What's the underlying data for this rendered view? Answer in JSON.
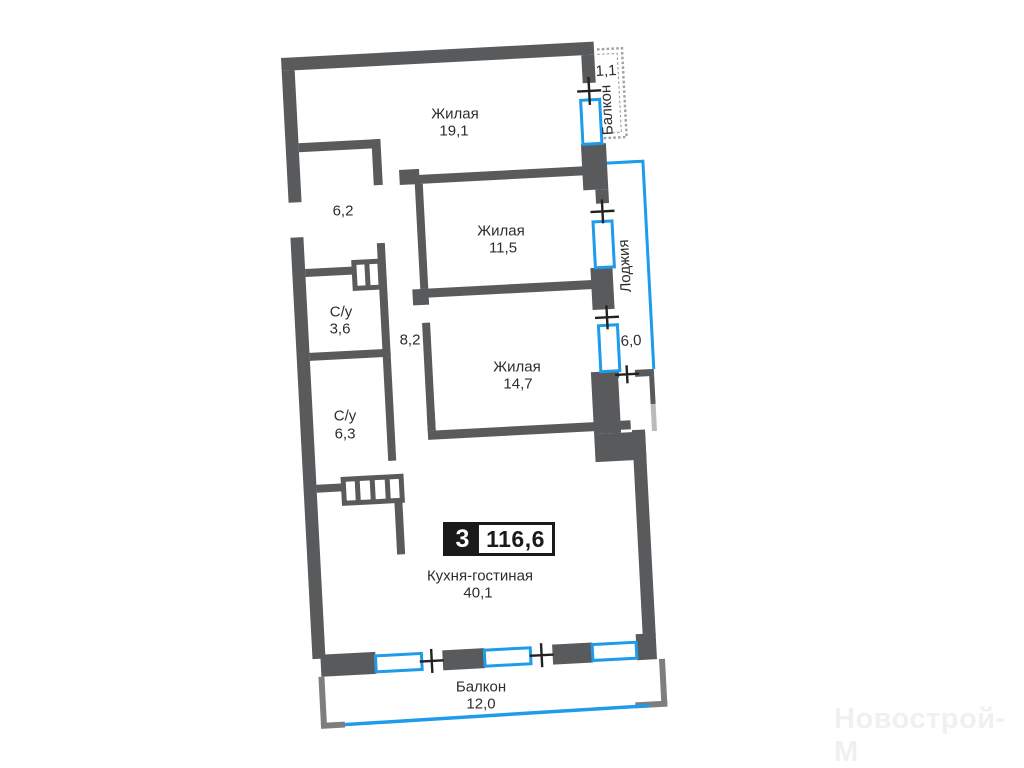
{
  "plan": {
    "badge": {
      "rooms": "3",
      "total_area": "116,6"
    },
    "rooms": [
      {
        "id": "living-1",
        "name": "Жилая",
        "area": "19,1"
      },
      {
        "id": "hallway",
        "name": "",
        "area": "6,2"
      },
      {
        "id": "living-2",
        "name": "Жилая",
        "area": "11,5"
      },
      {
        "id": "bathroom-1",
        "name": "С/у",
        "area": "3,6"
      },
      {
        "id": "corridor",
        "name": "",
        "area": "8,2"
      },
      {
        "id": "living-3",
        "name": "Жилая",
        "area": "14,7"
      },
      {
        "id": "bathroom-2",
        "name": "С/у",
        "area": "6,3"
      },
      {
        "id": "kitchen-living",
        "name": "Кухня-гостиная",
        "area": "40,1"
      },
      {
        "id": "balcony-top",
        "name": "Балкон",
        "area": "1,1"
      },
      {
        "id": "loggia",
        "name": "Лоджия",
        "area": "6,0"
      },
      {
        "id": "balcony-bottom",
        "name": "Балкон",
        "area": "12,0"
      }
    ],
    "watermark": "Новострой-М",
    "colors": {
      "wall": "#595A5C",
      "wall_light": "#b9babc",
      "thin_edge": "#7d7e80",
      "window_blue": "#1E9BE9",
      "railing": "#a0a4a7",
      "text": "#2d2d2d",
      "badge_black": "#1a1a1a",
      "watermark": "#f0f0f0"
    }
  }
}
